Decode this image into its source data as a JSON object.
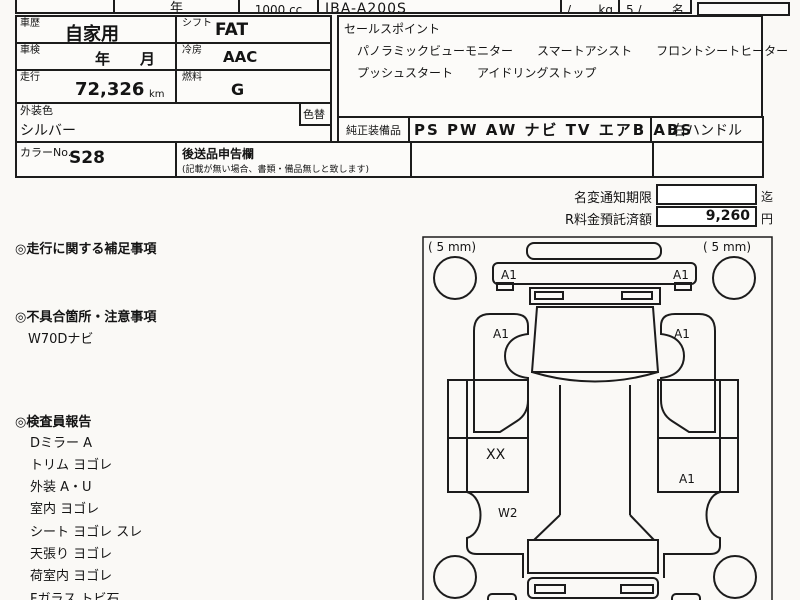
{
  "top_row": {
    "blank_box": "",
    "year_label": "年",
    "displacement": "1000 cc",
    "model_code": "JBA-A200S",
    "weight_slash": "/",
    "weight_unit": "kg",
    "capacity_value": "5 /",
    "capacity_unit": "名"
  },
  "spec_table": {
    "history_label": "車歴",
    "history_value": "自家用",
    "shift_label": "シフト",
    "shift_value": "FAT",
    "inspection_label": "車検",
    "inspection_value": "年　　月",
    "ac_label": "冷房",
    "ac_value": "AAC",
    "mileage_label": "走行",
    "mileage_value": "72,326",
    "mileage_unit": "km",
    "fuel_label": "燃料",
    "fuel_value": "G",
    "ext_color_label": "外装色",
    "ext_color_value": "シルバー",
    "color_change_label": "色替",
    "color_no_label": "カラーNo.",
    "color_no_value": "S28",
    "later_items_label": "後送品申告欄",
    "later_items_note": "(記載が無い場合、書類・備品無しと致します)"
  },
  "sales_points": {
    "label": "セールスポイント",
    "line1": "パノラミックビューモニター　　スマートアシスト　　フロントシートヒーター",
    "line2": "プッシュスタート　　アイドリングストップ"
  },
  "equipment": {
    "label": "純正装備品",
    "value": "PS PW AW ナビ TV エアB ABS",
    "handle": "右ハンドル"
  },
  "notice": {
    "name_change_label": "名変通知期限",
    "name_change_value": "",
    "name_change_suffix": "迄",
    "r_fee_label": "R料金預託済額",
    "r_fee_value": "9,260",
    "r_fee_suffix": "円"
  },
  "notes": {
    "mileage_note_title": "◎走行に関する補足事項",
    "defect_title": "◎不具合箇所・注意事項",
    "defect_item": "W70Dナビ",
    "inspector_title": "◎検査員報告",
    "inspector_items": [
      "Dミラー A",
      "トリム ヨゴレ",
      "外装 A・U",
      "室内 ヨゴレ",
      "シート ヨゴレ スレ",
      "天張り ヨゴレ",
      "荷室内 ヨゴレ",
      "Fガラス トビ石"
    ]
  },
  "diagram": {
    "tire_front_left": "( 5 mm)",
    "tire_front_right": "( 5 mm)",
    "labels": {
      "bumper_left": "A1",
      "bumper_right": "A1",
      "fender_left": "A1",
      "fender_right": "A1",
      "door_left": "XX",
      "rear_left": "W2",
      "quarter_right": "A1"
    }
  }
}
